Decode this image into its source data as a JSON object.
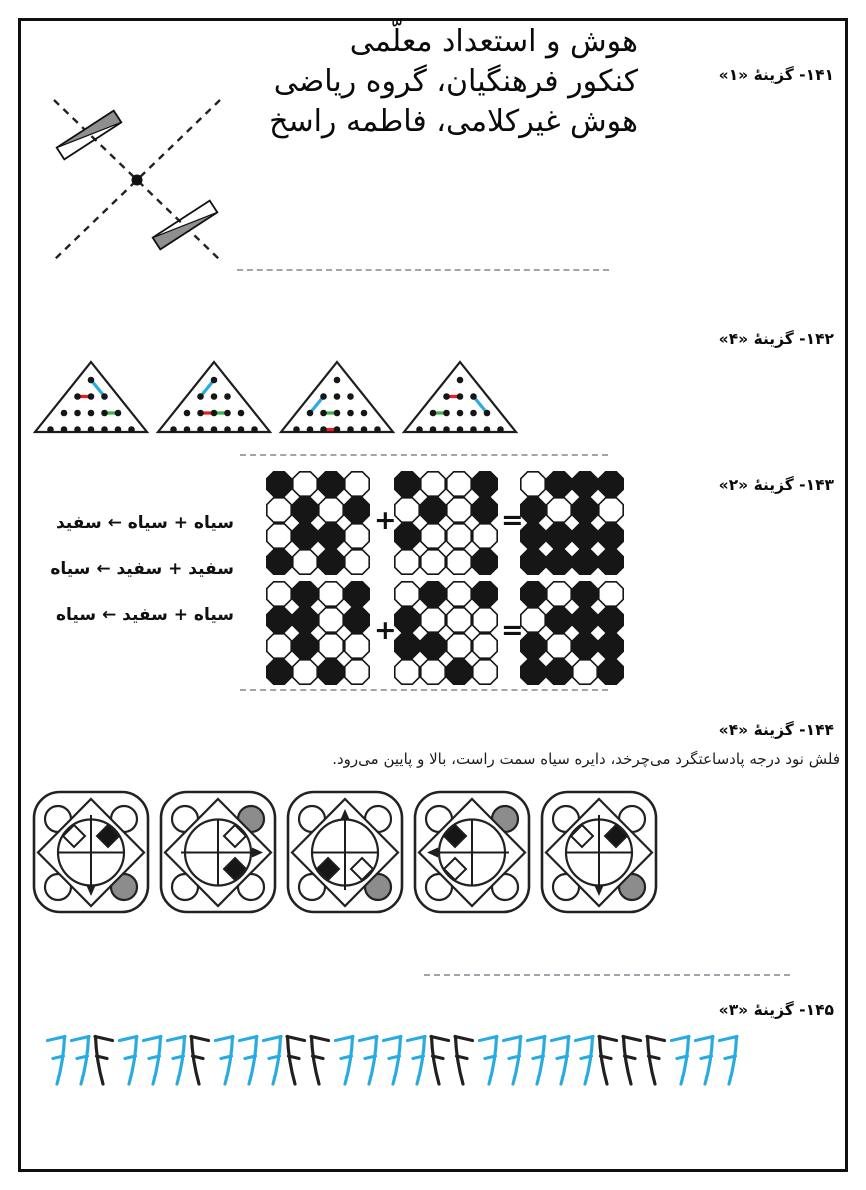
{
  "header": {
    "title_lines": [
      "هوش و استعداد معلّمی",
      "کنکور فرهنگیان، گروه ریاضی",
      "هوش غیرکلامی، فاطمه راسخ"
    ]
  },
  "colors": {
    "blue": "#29ABE2",
    "red": "#ED1C24",
    "green": "#39B54A",
    "gray": "#8C8C8C",
    "ink": "#231F20"
  },
  "answers": {
    "q141": {
      "label": "۱۴۱- گزینهٔ «۱»"
    },
    "q142": {
      "label": "۱۴۲- گزینهٔ «۴»"
    },
    "q143": {
      "label": "۱۴۳- گزینهٔ «۲»",
      "plus": "+",
      "equals": "=",
      "rules": [
        "سیاه + سیاه ← سفید",
        "سفید + سفید ← سیاه",
        "سیاه + سفید ← سیاه"
      ],
      "grids": {
        "row1": {
          "a": [
            "BWBW",
            "WBWB",
            "WBBW",
            "BWBW"
          ],
          "b": [
            "BWWB",
            "WBWB",
            "BWWW",
            "WWWB"
          ],
          "result": [
            "WBBB",
            "BWBW",
            "BBBB",
            "BBBB"
          ]
        },
        "row2": {
          "a": [
            "WBWB",
            "BBWB",
            "WBWW",
            "BWBW"
          ],
          "b": [
            "WBWB",
            "BWWW",
            "BBWW",
            "WWBW"
          ],
          "result": [
            "BWBW",
            "WBBB",
            "BWBB",
            "BBWB"
          ]
        }
      }
    },
    "q144": {
      "label": "۱۴۴- گزینهٔ «۴»",
      "explanation": "فلش نود درجه پادساعتگرد می‌چرخد، دایره سیاه سمت راست، بالا و پایین می‌رود.",
      "panels": [
        {
          "gray_circle": "bottom-right",
          "arrow": "down",
          "white_diamond": "top-left",
          "black_diamond": "top-right"
        },
        {
          "gray_circle": "top-right",
          "arrow": "right",
          "white_diamond": "top-right",
          "black_diamond": "bottom-right"
        },
        {
          "gray_circle": "bottom-right",
          "arrow": "up",
          "white_diamond": "bottom-right",
          "black_diamond": "bottom-left"
        },
        {
          "gray_circle": "top-right",
          "arrow": "left",
          "white_diamond": "bottom-left",
          "black_diamond": "top-left"
        },
        {
          "gray_circle": "bottom-right",
          "arrow": "down",
          "white_diamond": "top-left",
          "black_diamond": "top-right"
        }
      ]
    },
    "q145": {
      "label": "۱۴۵- گزینهٔ «۳»",
      "sequence": [
        "blue-7",
        "blue-7",
        "black-mirrored-7",
        "blue-7",
        "blue-7",
        "blue-7",
        "black-mirrored-7",
        "blue-7",
        "blue-7",
        "blue-7",
        "black-mirrored-7",
        "black-mirrored-7",
        "blue-7",
        "blue-7",
        "blue-7",
        "blue-7",
        "black-mirrored-7",
        "black-mirrored-7",
        "blue-7",
        "blue-7",
        "blue-7",
        "blue-7",
        "blue-7",
        "black-mirrored-7",
        "black-mirrored-7",
        "black-mirrored-7",
        "blue-7",
        "blue-7",
        "blue-7"
      ]
    }
  },
  "figures": {
    "q142_triangles": [
      {
        "segments": [
          {
            "color": "red",
            "from": [
              2,
              1
            ],
            "to": [
              2,
              2
            ]
          },
          {
            "color": "blue",
            "from": [
              1,
              1
            ],
            "to": [
              2,
              3
            ]
          },
          {
            "color": "green",
            "from": [
              3,
              4
            ],
            "to": [
              3,
              5
            ]
          }
        ]
      },
      {
        "segments": [
          {
            "color": "blue",
            "from": [
              1,
              1
            ],
            "to": [
              2,
              1
            ]
          },
          {
            "color": "red",
            "from": [
              3,
              2
            ],
            "to": [
              3,
              3
            ]
          },
          {
            "color": "green",
            "from": [
              3,
              3
            ],
            "to": [
              3,
              4
            ]
          }
        ]
      },
      {
        "segments": [
          {
            "color": "blue",
            "from": [
              2,
              1
            ],
            "to": [
              3,
              1
            ]
          },
          {
            "color": "green",
            "from": [
              3,
              2
            ],
            "to": [
              3,
              3
            ]
          },
          {
            "color": "red",
            "from": [
              4,
              3
            ],
            "to": [
              4,
              4
            ]
          }
        ]
      },
      {
        "segments": [
          {
            "color": "red",
            "from": [
              2,
              1
            ],
            "to": [
              2,
              2
            ]
          },
          {
            "color": "green",
            "from": [
              3,
              1
            ],
            "to": [
              3,
              2
            ]
          },
          {
            "color": "blue",
            "from": [
              2,
              3
            ],
            "to": [
              3,
              5
            ]
          }
        ]
      }
    ]
  }
}
